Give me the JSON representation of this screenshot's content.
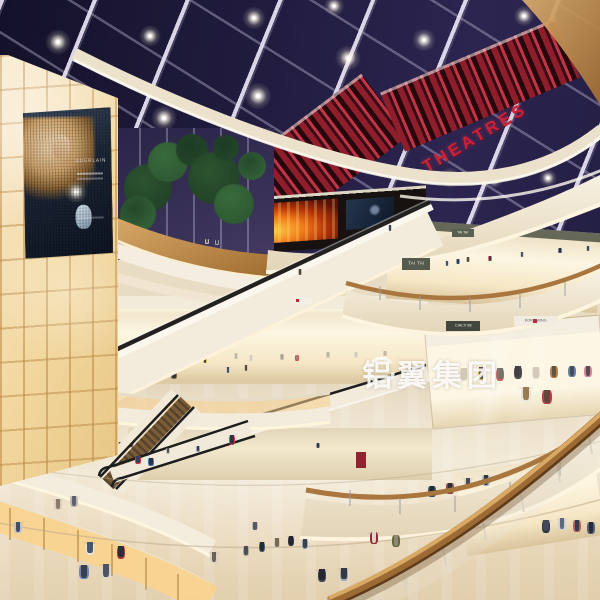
{
  "meta": {
    "description": "Night-lit multi-level shopping mall atrium rendering with skylight, curved balconies, escalators and cinema level",
    "width": 600,
    "height": 600
  },
  "texts": {
    "theatre_sign": "THEATRES",
    "watermark": "铝翼集团",
    "billboard_brand": "GUERLAIN",
    "sign_tai_tai": "TAI TAI",
    "sign_cialti": "CIALTI 88",
    "sign_korn": "KORN WING"
  },
  "colors": {
    "skylight": "#221d40",
    "beam": "#cfcadb",
    "marquee_red": "#c03448",
    "theatre_letter_red": "#cf2038",
    "fascia_cream": "#f3ebd9",
    "wood_rail": "#9c6a34",
    "wall_glow": "#f6e3b4",
    "floor": "#e9dcc4",
    "glass_glow": "#f9d38e",
    "skin": "#c9a07e"
  },
  "scene": {
    "stars": [
      [
        58,
        42,
        1
      ],
      [
        150,
        36,
        0.85
      ],
      [
        164,
        118,
        1
      ],
      [
        254,
        18,
        0.9
      ],
      [
        258,
        96,
        1.05
      ],
      [
        348,
        58,
        1
      ],
      [
        334,
        6,
        0.8
      ],
      [
        424,
        40,
        0.9
      ],
      [
        460,
        98,
        1
      ],
      [
        524,
        16,
        0.8
      ],
      [
        120,
        150,
        0.7
      ],
      [
        210,
        166,
        0.75
      ],
      [
        450,
        178,
        0.8
      ],
      [
        494,
        180,
        0.65
      ],
      [
        548,
        178,
        0.7
      ],
      [
        238,
        308,
        0.55
      ],
      [
        524,
        304,
        0.6
      ],
      [
        352,
        240,
        0.55
      ],
      [
        168,
        268,
        0.5
      ]
    ],
    "trees": [
      [
        148,
        188,
        24
      ],
      [
        168,
        162,
        20
      ],
      [
        138,
        214,
        18
      ],
      [
        192,
        150,
        16
      ],
      [
        214,
        178,
        26
      ],
      [
        234,
        204,
        20
      ],
      [
        252,
        166,
        14
      ],
      [
        226,
        148,
        13
      ]
    ],
    "people_back": [
      [
        447,
        274,
        13,
        "#d2d8e2",
        "#4a505c"
      ],
      [
        458,
        272,
        13,
        "#8a9ab8",
        "#343a46"
      ],
      [
        468,
        270,
        13,
        "#c6baa6",
        "#564a3c"
      ],
      [
        490,
        268,
        12,
        "#d86a6a",
        "#3a4050"
      ],
      [
        522,
        264,
        12,
        "#d8d4ca",
        "#4e5462"
      ],
      [
        560,
        260,
        12,
        "#6c7a96",
        "#2e323e"
      ],
      [
        588,
        258,
        12,
        "#c4ceda",
        "#404652"
      ],
      [
        207,
        250,
        11,
        "#cac4b6",
        "#4c515a"
      ],
      [
        217,
        251,
        11,
        "#9ca6ba",
        "#383e4a"
      ],
      [
        465,
        254,
        12,
        "#bac4d4",
        "#3e4452"
      ],
      [
        478,
        252,
        12,
        "#d8d2c4",
        "#4a505e"
      ],
      [
        32,
        396,
        25,
        "#d6d1c7",
        "#4f555f"
      ],
      [
        64,
        393,
        23,
        "#c4bfb4",
        "#575d66"
      ],
      [
        110,
        386,
        17,
        "#bab09c",
        "#4c4136"
      ],
      [
        160,
        392,
        19,
        "#ded9cf",
        "#5c626c"
      ],
      [
        174,
        390,
        19,
        "#7c6c5a",
        "#31353e"
      ],
      [
        228,
        382,
        15,
        "#cacdd7",
        "#484e5a"
      ],
      [
        246,
        380,
        15,
        "#d4c8b4",
        "#584b3c"
      ],
      [
        110,
        462,
        22,
        "#d8d4ca",
        "#5a5f6a"
      ],
      [
        121,
        464,
        22,
        "#9aa8c0",
        "#3c4452"
      ],
      [
        131,
        460,
        21,
        "#c8bfae",
        "#56493c"
      ],
      [
        432,
        512,
        26,
        "#3c4a60",
        "#222630"
      ],
      [
        450,
        509,
        26,
        "#8a4444",
        "#2e3038"
      ],
      [
        468,
        505,
        27,
        "#ddd6c8",
        "#434b58"
      ],
      [
        486,
        502,
        27,
        "#9fb0cc",
        "#30363e"
      ],
      [
        578,
        492,
        29,
        "#c6ccd8",
        "#3e4656"
      ]
    ],
    "people_front": [
      [
        90,
        572,
        30,
        "#e9e5db",
        "#46566e"
      ],
      [
        121,
        576,
        30,
        "#a23b33",
        "#2a2d3a"
      ],
      [
        84,
        598,
        33,
        "#6d86b8",
        "#39404e"
      ],
      [
        106,
        597,
        33,
        "#d9d5c9",
        "#4e5460"
      ],
      [
        58,
        524,
        25,
        "#d9cfc0",
        "#8a7a66"
      ],
      [
        74,
        521,
        25,
        "#c5b8a6",
        "#5b6270"
      ],
      [
        18,
        548,
        26,
        "#b8c4d4",
        "#454f5e"
      ],
      [
        138,
        474,
        18,
        "#c94040",
        "#35405c"
      ],
      [
        151,
        476,
        18,
        "#3f78c2",
        "#2d3140"
      ],
      [
        232,
        458,
        23,
        "#cc4455",
        "#2e3444"
      ],
      [
        214,
        578,
        26,
        "#d9d2c2",
        "#6e6258"
      ],
      [
        246,
        570,
        24,
        "#b0a894",
        "#4a4f5a"
      ],
      [
        262,
        566,
        24,
        "#46608e",
        "#262c38"
      ],
      [
        277,
        562,
        24,
        "#cfc9bb",
        "#7e6a50"
      ],
      [
        291,
        560,
        24,
        "#343a46",
        "#23262e"
      ],
      [
        305,
        563,
        24,
        "#8b9bb4",
        "#39404e"
      ],
      [
        255,
        542,
        20,
        "#c2b49c",
        "#555b66"
      ],
      [
        374,
        560,
        28,
        "#8e2a36",
        "#ded6c6"
      ],
      [
        396,
        563,
        28,
        "#5f6a3a",
        "#8f8878"
      ],
      [
        322,
        599,
        30,
        "#3e4656",
        "#232832"
      ],
      [
        344,
        598,
        30,
        "#9aa6bc",
        "#323844"
      ],
      [
        546,
        550,
        30,
        "#2e3340",
        "#40485a"
      ],
      [
        562,
        546,
        28,
        "#ccd2da",
        "#5e6878"
      ],
      [
        577,
        548,
        28,
        "#b06060",
        "#353c4e"
      ],
      [
        591,
        550,
        28,
        "#55607a",
        "#262b36"
      ],
      [
        526,
        420,
        33,
        "#e8e4da",
        "#9a7a52"
      ],
      [
        547,
        423,
        33,
        "#c23a4e",
        "#5e4a3a"
      ],
      [
        390,
        240,
        15,
        "#cfd8e4",
        "#39404e"
      ],
      [
        300,
        284,
        15,
        "#c2b8a8",
        "#4a4438"
      ],
      [
        168,
        462,
        14,
        "#c8c2b6",
        "#4a4f58"
      ],
      [
        198,
        460,
        14,
        "#9aa4b6",
        "#363c46"
      ],
      [
        318,
        456,
        13,
        "#8c96a8",
        "#323844"
      ]
    ],
    "mannequins_center": [
      [
        142,
        372,
        16,
        "#ddd6c8",
        "#cbc2b2"
      ],
      [
        158,
        374,
        16,
        "#c9c0b0",
        "#b8ab98"
      ],
      [
        190,
        370,
        15,
        "#e2dccf",
        "#ccc2b0"
      ],
      [
        205,
        372,
        15,
        "#d8b83a",
        "#3a3631"
      ],
      [
        236,
        368,
        15,
        "#d6cfc0",
        "#c2b8a6"
      ],
      [
        251,
        370,
        15,
        "#e8e2d4",
        "#d2c8b6"
      ],
      [
        282,
        368,
        14,
        "#c2baa9",
        "#a89e8c"
      ],
      [
        297,
        369,
        14,
        "#b84848",
        "#8c8376"
      ],
      [
        328,
        366,
        14,
        "#cfc8b8",
        "#bab09e"
      ],
      [
        356,
        366,
        14,
        "#e4ddcf",
        "#cfc5b4"
      ],
      [
        385,
        364,
        13,
        "#d2caba",
        "#beb4a2"
      ]
    ],
    "mannequins_store": [
      [
        464,
        400,
        32,
        "#e6e0d2",
        "#cfc6b4"
      ],
      [
        482,
        398,
        31,
        "#d8c23e",
        "#3c3832"
      ],
      [
        500,
        398,
        30,
        "#c23e3e",
        "#58514a"
      ],
      [
        518,
        396,
        30,
        "#3c3c40",
        "#2c2c30"
      ],
      [
        536,
        396,
        29,
        "#e2dccc",
        "#c9bfae"
      ],
      [
        554,
        394,
        28,
        "#b8743c",
        "#5a4632"
      ],
      [
        572,
        393,
        27,
        "#5878a8",
        "#38404e"
      ],
      [
        588,
        392,
        26,
        "#d87a96",
        "#4a4048"
      ]
    ]
  }
}
